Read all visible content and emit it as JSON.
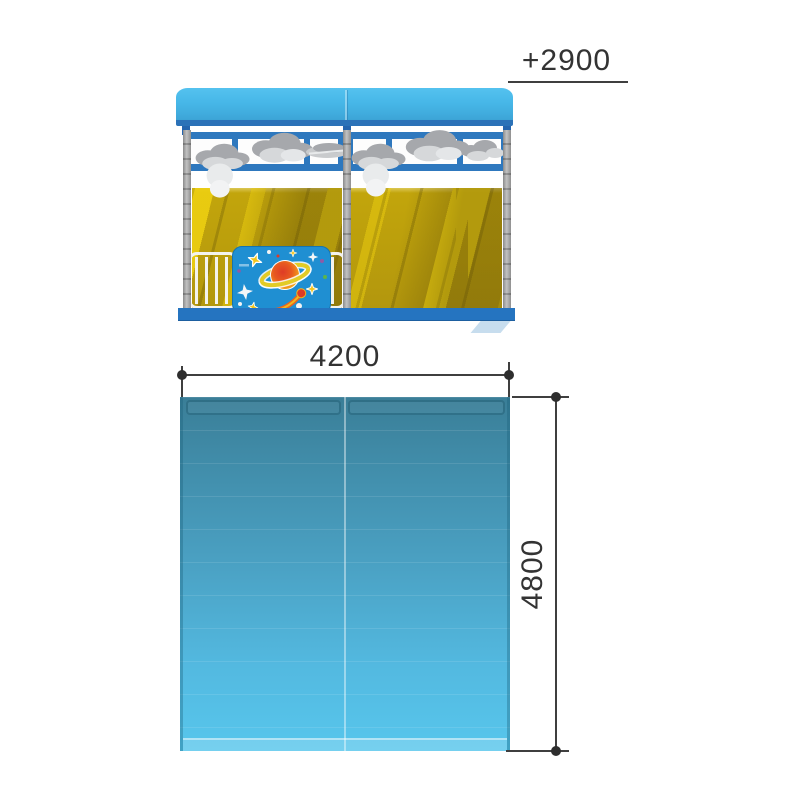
{
  "drawing": {
    "dimensions": {
      "level": {
        "label": "+2900",
        "orientation": "level-mark"
      },
      "width": {
        "label": "4200",
        "orientation": "horizontal"
      },
      "depth": {
        "label": "4800",
        "orientation": "vertical"
      }
    },
    "elevation": {
      "colors": {
        "roof_blue": "#47b7e8",
        "frame_blue": "#2e78be",
        "base_blue": "#2574c0",
        "wall_yellow_bright": "#e9cb12",
        "wall_olive": "#ad920e",
        "post_gray": "#a9a9a9",
        "panel_blue": "#1f8fd2",
        "cloud_dark": "#a6a8ac",
        "cloud_light": "#d6d8da"
      },
      "decor": [
        "clouds",
        "saturn-planet",
        "stars",
        "comet",
        "railing"
      ]
    },
    "plan": {
      "colors": {
        "top_teal": "#3a7e97",
        "bottom_blue": "#57c6ec"
      }
    },
    "annotation_color": "#333333"
  }
}
